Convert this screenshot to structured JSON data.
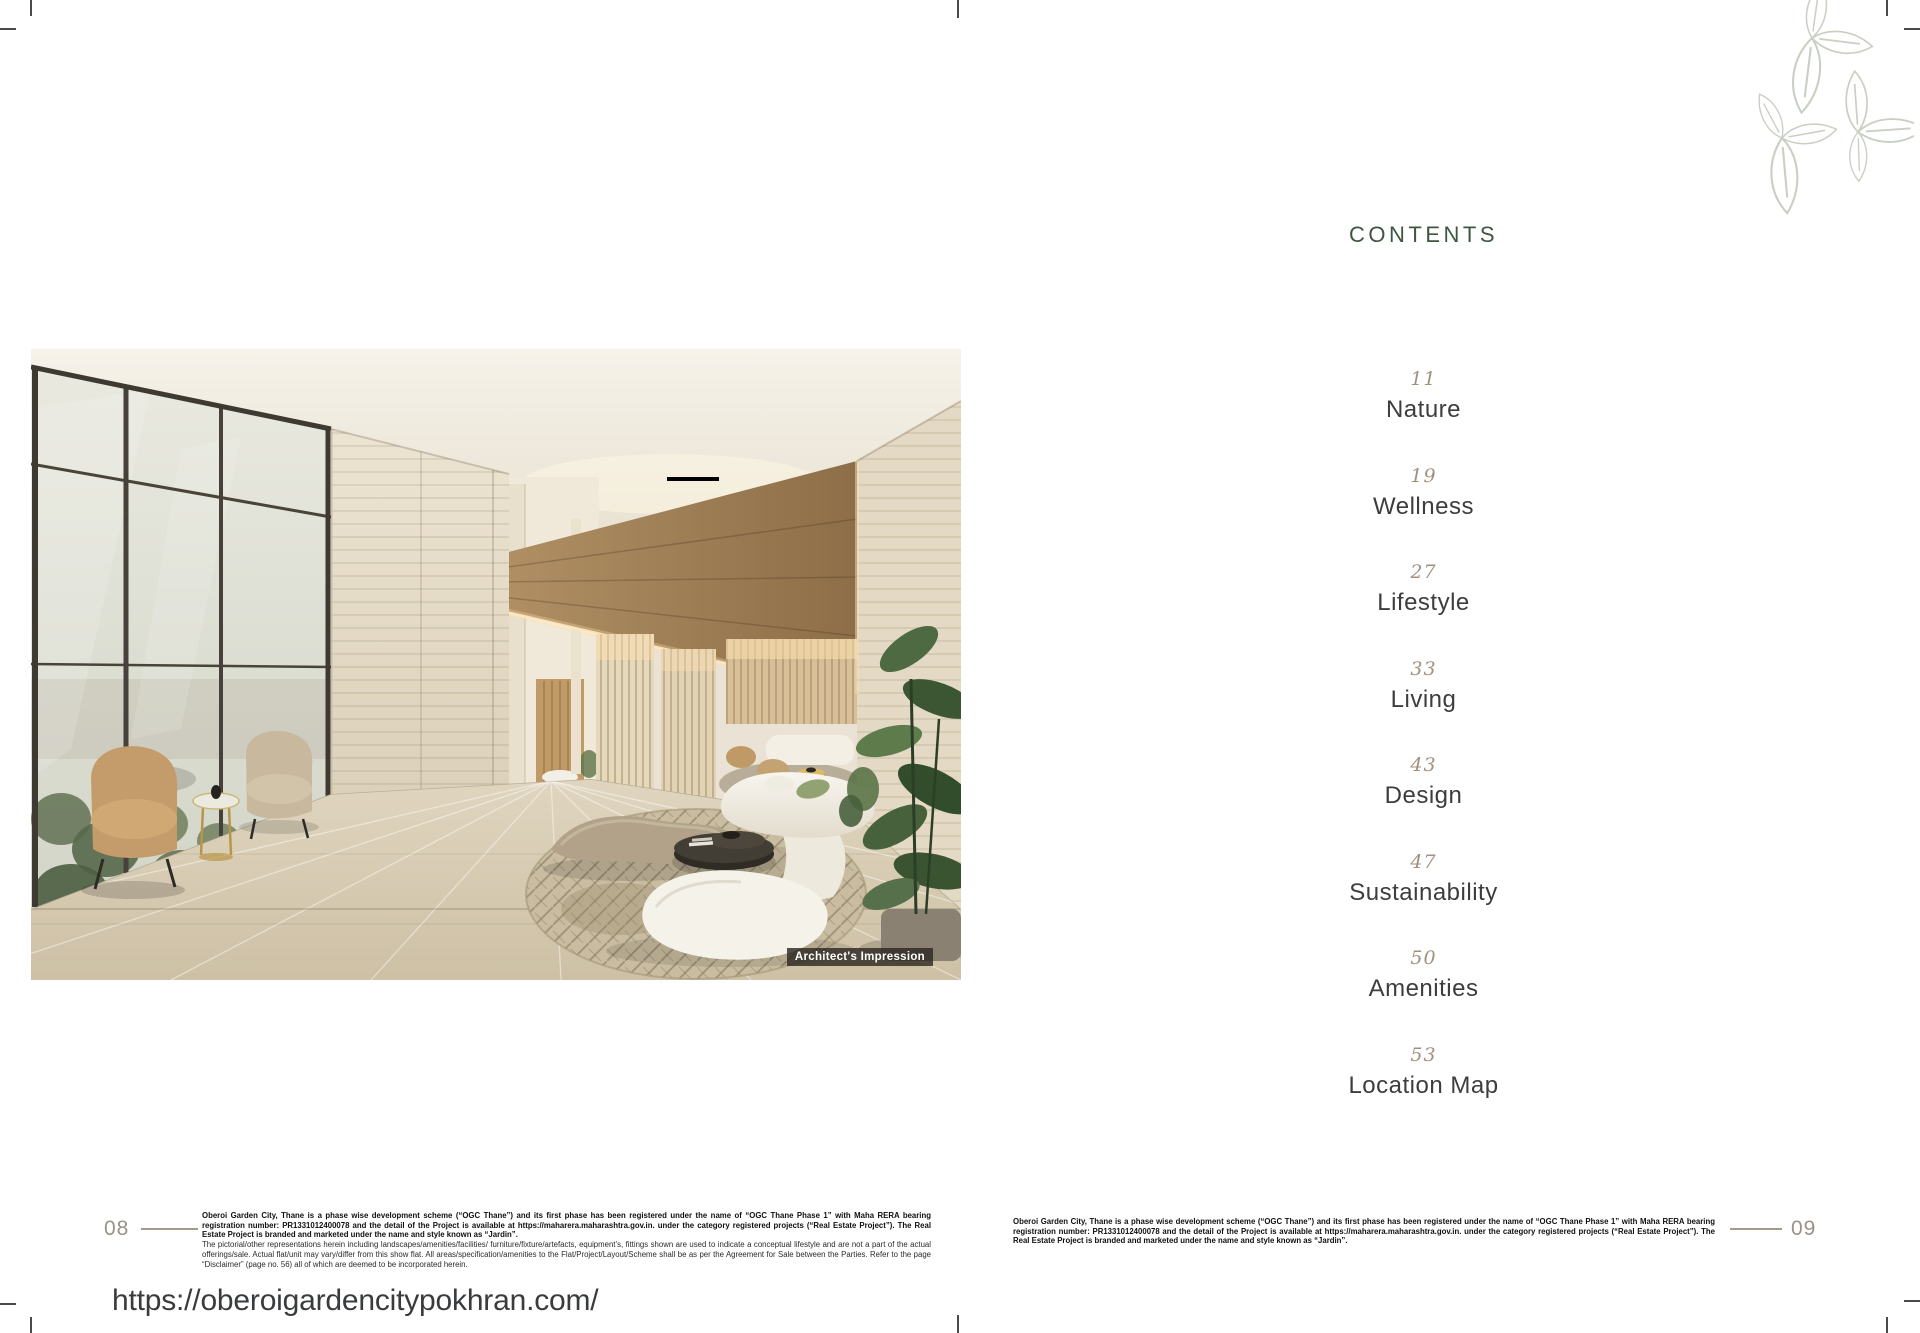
{
  "left_page": {
    "page_number": "08",
    "image_caption": "Architect's Impression",
    "disclaimer_bold": "Oberoi Garden City, Thane is a phase wise development scheme (“OGC Thane”) and its first phase has been registered under the name of “OGC Thane Phase 1” with Maha RERA bearing registration number: PR1331012400078 and the detail of the Project is available at https://maharera.maharashtra.gov.in. under the category registered projects (“Real Estate Project”). The Real Estate Project is branded and marketed under the name and style known as “Jardin”.",
    "disclaimer_regular": "The pictorial/other representations herein including landscapes/amenities/facilities/ furniture/fixture/artefacts, equipment’s, fittings shown are used to indicate a conceptual lifestyle and are not a part of the actual offerings/sale. Actual flat/unit may vary/differ from this show flat. All areas/specification/amenities to the Flat/Project/Layout/Scheme shall be as per the Agreement for Sale between the Parties. Refer to the page “Disclaimer” (page no. 56) all of which are deemed to be incorporated herein."
  },
  "right_page": {
    "page_number": "09",
    "heading": "CONTENTS",
    "toc": {
      "entries": [
        {
          "page": "11",
          "label": "Nature"
        },
        {
          "page": "19",
          "label": "Wellness"
        },
        {
          "page": "27",
          "label": "Lifestyle"
        },
        {
          "page": "33",
          "label": "Living"
        },
        {
          "page": "43",
          "label": "Design"
        },
        {
          "page": "47",
          "label": "Sustainability"
        },
        {
          "page": "50",
          "label": "Amenities"
        },
        {
          "page": "53",
          "label": "Location Map"
        }
      ]
    },
    "disclaimer_bold": "Oberoi Garden City, Thane is a phase wise development scheme (“OGC Thane”) and its first phase has been registered under the name of “OGC Thane Phase 1” with Maha RERA bearing registration number: PR1331012400078 and the detail of the Project is available at https://maharera.maharashtra.gov.in. under the category registered projects (“Real Estate Project”). The Real Estate Project is branded and marketed under the name and style known as “Jardin”."
  },
  "footer_url": "https://oberoigardencitypokhran.com/",
  "icons": {
    "logo": "leaf-cluster-logo"
  },
  "colors": {
    "contents_heading": "#3f5640",
    "toc_number": "#a2907f",
    "toc_label": "#3d3d3d",
    "page_number": "#9a9187",
    "logo_stroke": "#c9cfc3",
    "caption_bg": "rgba(42,38,31,0.8)",
    "caption_text": "#ffffff",
    "url_text": "#393b3d"
  }
}
